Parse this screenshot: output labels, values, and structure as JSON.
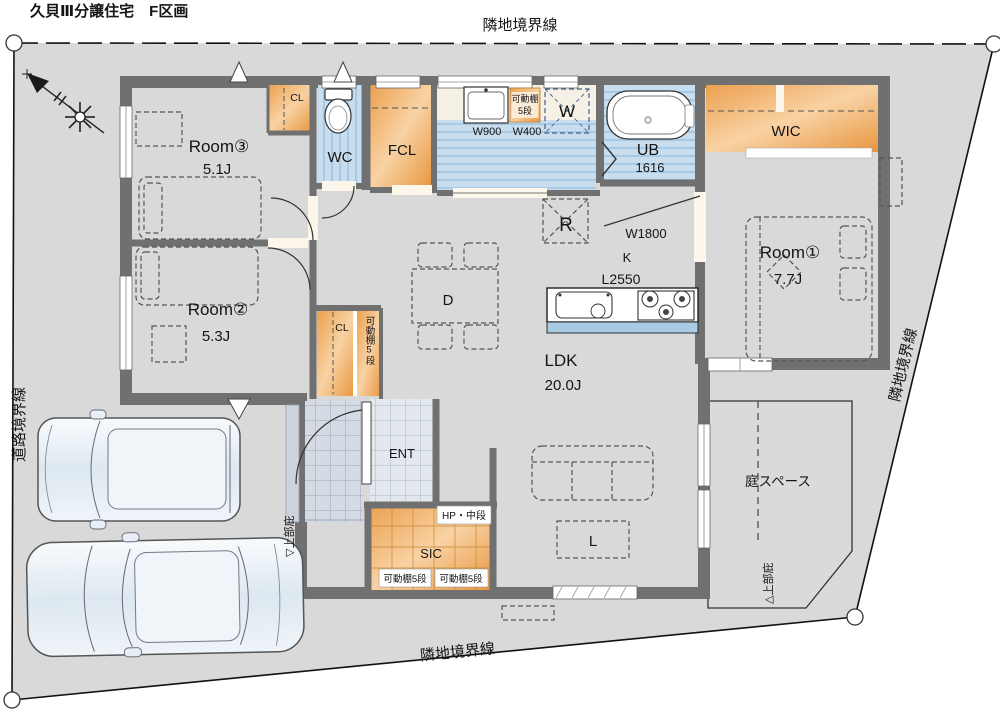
{
  "title": "久貝Ⅲ分譲住宅　F区画",
  "boundaries": {
    "top": "隣地境界線",
    "right": "隣地境界線",
    "bottom": "隣地境界線",
    "left": "道路境界線"
  },
  "rooms": {
    "room3": {
      "name": "Room③",
      "area": "5.1J"
    },
    "room2": {
      "name": "Room②",
      "area": "5.3J"
    },
    "room1": {
      "name": "Room①",
      "area": "7.7J"
    },
    "ldk": {
      "name": "LDK",
      "area": "20.0J"
    },
    "wic": "WIC",
    "wc": "WC",
    "fcl": "FCL",
    "ub": {
      "name": "UB",
      "size": "1616"
    },
    "ent": "ENT",
    "sic": "SIC",
    "cl_upper": "CL",
    "cl_lower": "CL",
    "garden": "庭スペース"
  },
  "kitchen": {
    "fridge": "R",
    "opening_width": "W1800",
    "label": "K",
    "counter_length": "L2550",
    "dining": "D",
    "living_table": "L",
    "washer": "W"
  },
  "storage": {
    "vanity_width": "W900",
    "shelf_width": "W400",
    "shelf_label_line1": "可動棚",
    "shelf_label_line2": "5段",
    "shelf_vertical": "可動棚5段",
    "hp": "HP・中段",
    "sic_shelf_left": "可動棚5段",
    "sic_shelf_right": "可動棚5段"
  },
  "annotations": {
    "canopy_porch": "▽上部庇",
    "canopy_garden": "△上部庇"
  },
  "colors": {
    "site_gray": "#d9d9d9",
    "wall_gray": "#707070",
    "floor_cream": "#f6e8d2",
    "closet_orange": "#efa352",
    "wet_blue": "#c8deef",
    "tile_blue_gray": "#e3e8ef"
  }
}
